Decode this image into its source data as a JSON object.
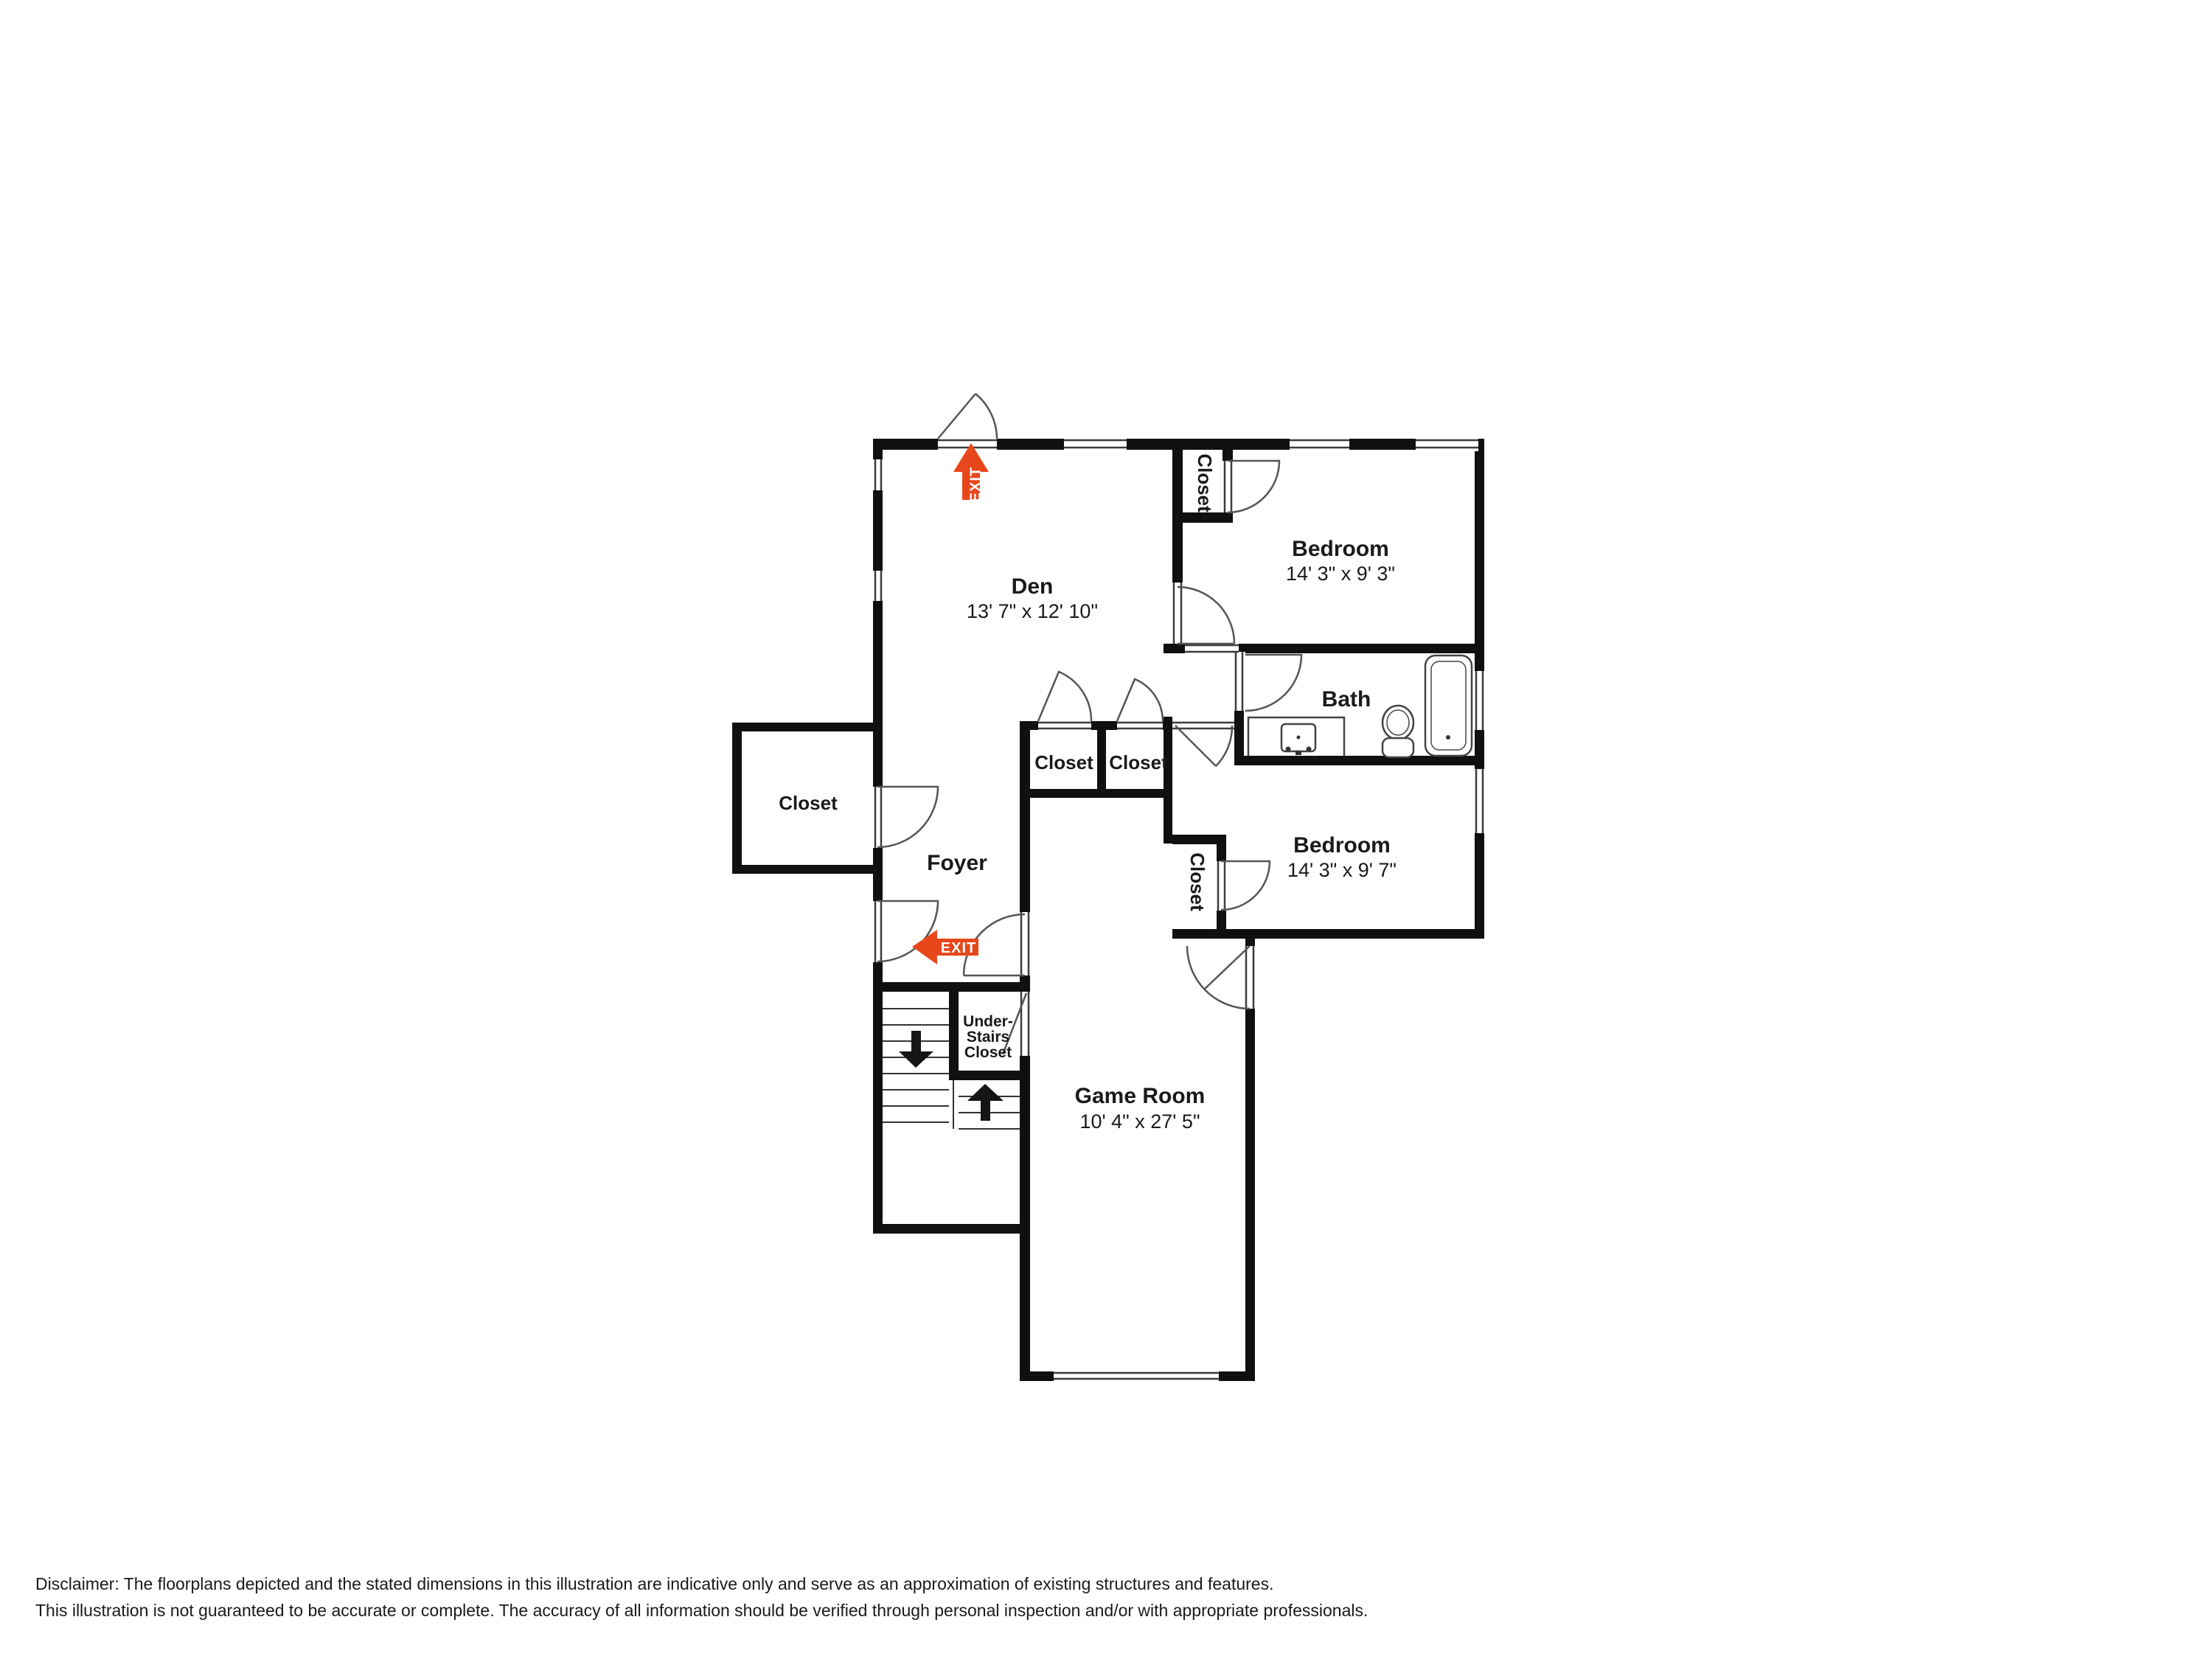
{
  "rooms": {
    "den": {
      "name": "Den",
      "dims": "13' 7\" x 12' 10\""
    },
    "bedroom_top": {
      "name": "Bedroom",
      "dims": "14' 3\" x 9' 3\""
    },
    "bath": {
      "name": "Bath"
    },
    "bedroom_bottom": {
      "name": "Bedroom",
      "dims": "14' 3\" x 9' 7\""
    },
    "game_room": {
      "name": "Game Room",
      "dims": "10' 4\" x 27' 5\""
    },
    "foyer": {
      "name": "Foyer"
    }
  },
  "closets": {
    "entry": "Closet",
    "hall_left": "Closet",
    "hall_right": "Closet",
    "bedroom_top": "Closet",
    "bedroom_bottom": "Closet",
    "under_stairs": [
      "Under-",
      "Stairs",
      "Closet"
    ]
  },
  "exit": {
    "label": "EXIT",
    "color": "#e8471c"
  },
  "colors": {
    "wall": "#101010",
    "thin_line": "#3c3c3c",
    "door_line": "#555555",
    "disclaimer_text": "#9aa0ad"
  },
  "disclaimer": {
    "line1": "Disclaimer: The floorplans depicted and the stated dimensions in this illustration are indicative only and serve as an approximation of existing structures and features.",
    "line2": "This illustration is not guaranteed to be accurate or complete. The accuracy of all information should be verified through personal inspection and/or with appropriate professionals."
  }
}
